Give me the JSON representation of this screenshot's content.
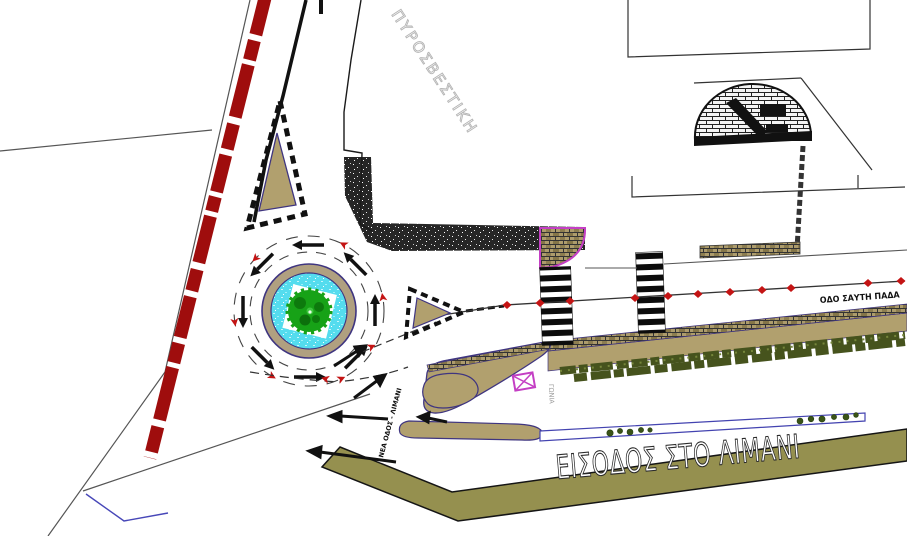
{
  "drawing": {
    "kind": "port entrance site plan (CAD)",
    "labels": {
      "port_entrance": "ΕΙΣΟΔΟΣ ΣΤΟ ΛΙΜΑΝΙ",
      "fire_station": "ΠΥΡΟΣΒΕΣΤΙΚΗ",
      "street_name": "ΟΔΟ ΣΑΥΤΗ ΠΑΔΑ",
      "corner_note": "ΓΩΝΙΑ",
      "road_note": "ΝΕΑ ΟΔΟΣ - ΛΙΜΑΝΙ"
    },
    "symbols": {
      "roundabout": "roundabout-with-fountain-and-tree",
      "railway": "red-dashed-boundary-line",
      "crosswalk": "zebra-crossing",
      "arch": "brick-arch-structure",
      "envelope": "magenta-crossed-box-symbol",
      "markers": "red-diamond-route-markers",
      "arrows": "traffic-direction-arrows",
      "hedge": "hedge-planting-strip",
      "median": "blue-median-island"
    },
    "colors": {
      "background": "#ffffff",
      "railway_red": "#9f0d0d",
      "khaki": "#b1a06e",
      "ring_tan": "#b0a080",
      "water_cyan": "#54dcee",
      "tree_green": "#17a217",
      "olive_band": "#95904f",
      "hedge_green": "#46531d",
      "outline_navy": "#3f3580",
      "magenta": "#c43fc4",
      "median_blue": "#4343b0",
      "asphalt_dark": "#262626",
      "label_gray": "#b4b4b4",
      "marker_red": "#c41414",
      "line_black": "#1a1a1a"
    }
  }
}
